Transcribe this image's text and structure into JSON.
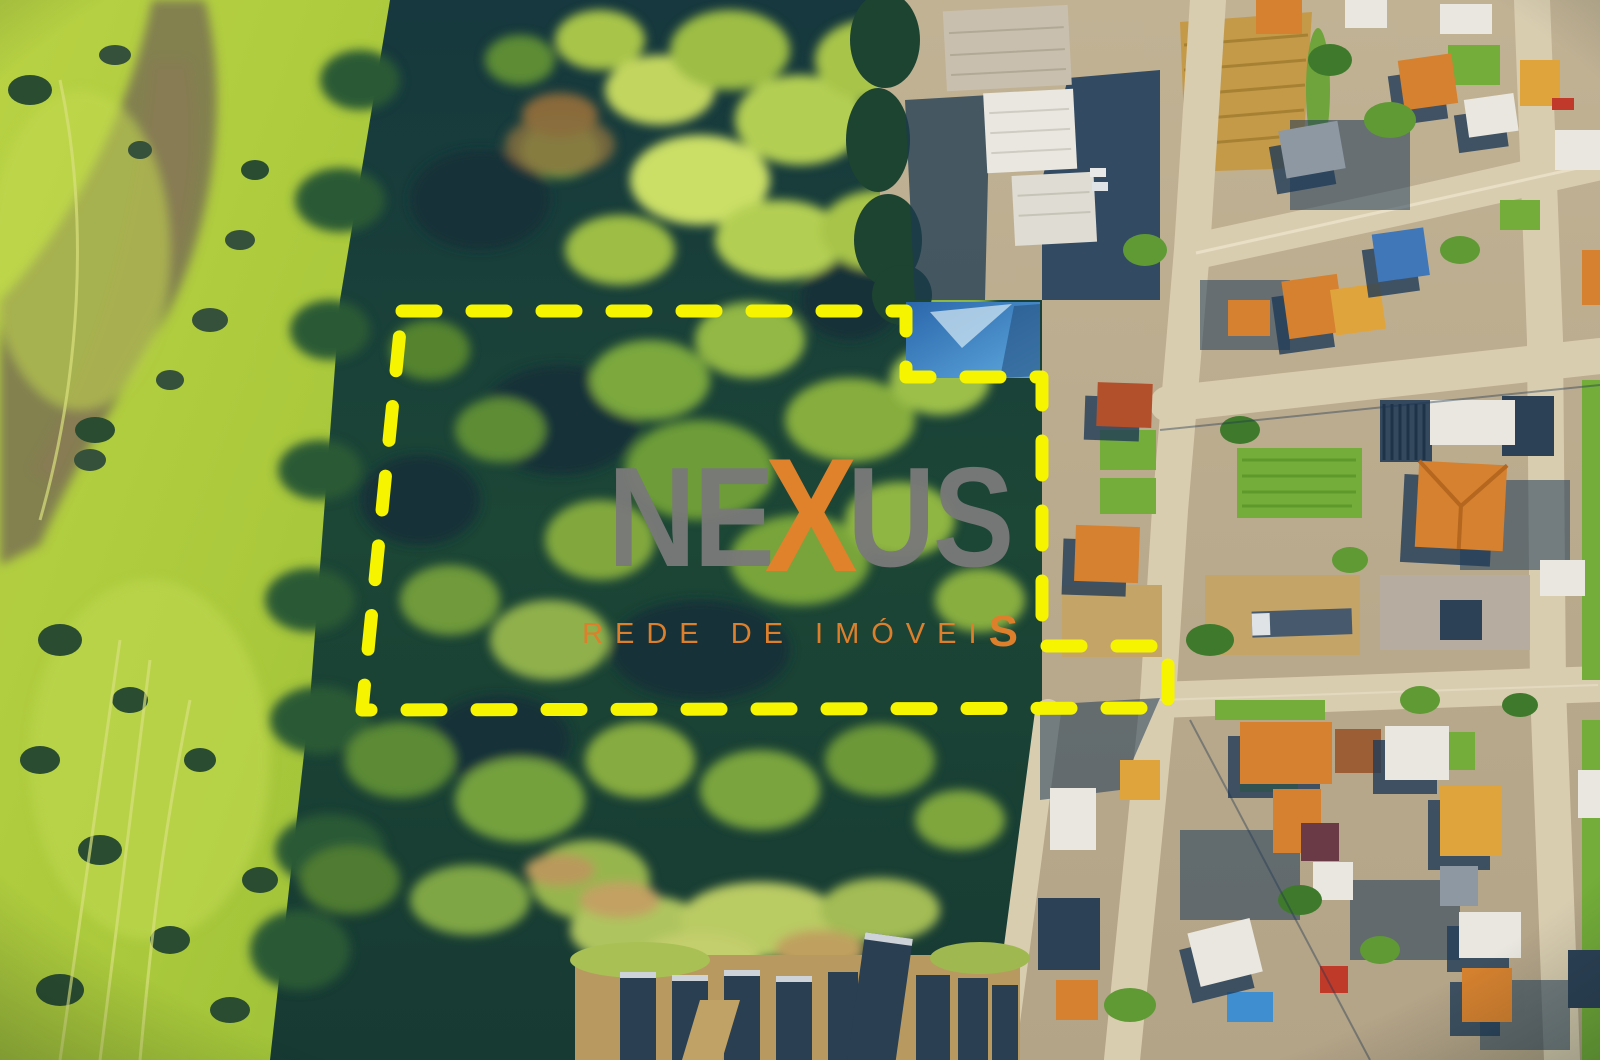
{
  "watermark": {
    "brand": {
      "prefix": "NE",
      "accent_letter": "X",
      "suffix": "US"
    },
    "tagline": {
      "text": "REDE DE IMÓVEI",
      "suffix_letter": "S"
    },
    "colors": {
      "letters_gray": "#797979",
      "accent_orange": "#e0812b"
    }
  },
  "property_boundary": {
    "shape": "dashed-polygon",
    "color": "#f7f400",
    "points": "402,311 906,311 906,377 1042,377 1042,646 1168,646 1168,708 362,710"
  },
  "scene": {
    "type": "aerial-drone-photograph",
    "regions": [
      "wetland-grassland-left",
      "forested-land-parcel-center",
      "residential-neighborhood-right",
      "industrial-warehouses-top-right",
      "dirt-lots-and-shed-row-bottom"
    ]
  }
}
